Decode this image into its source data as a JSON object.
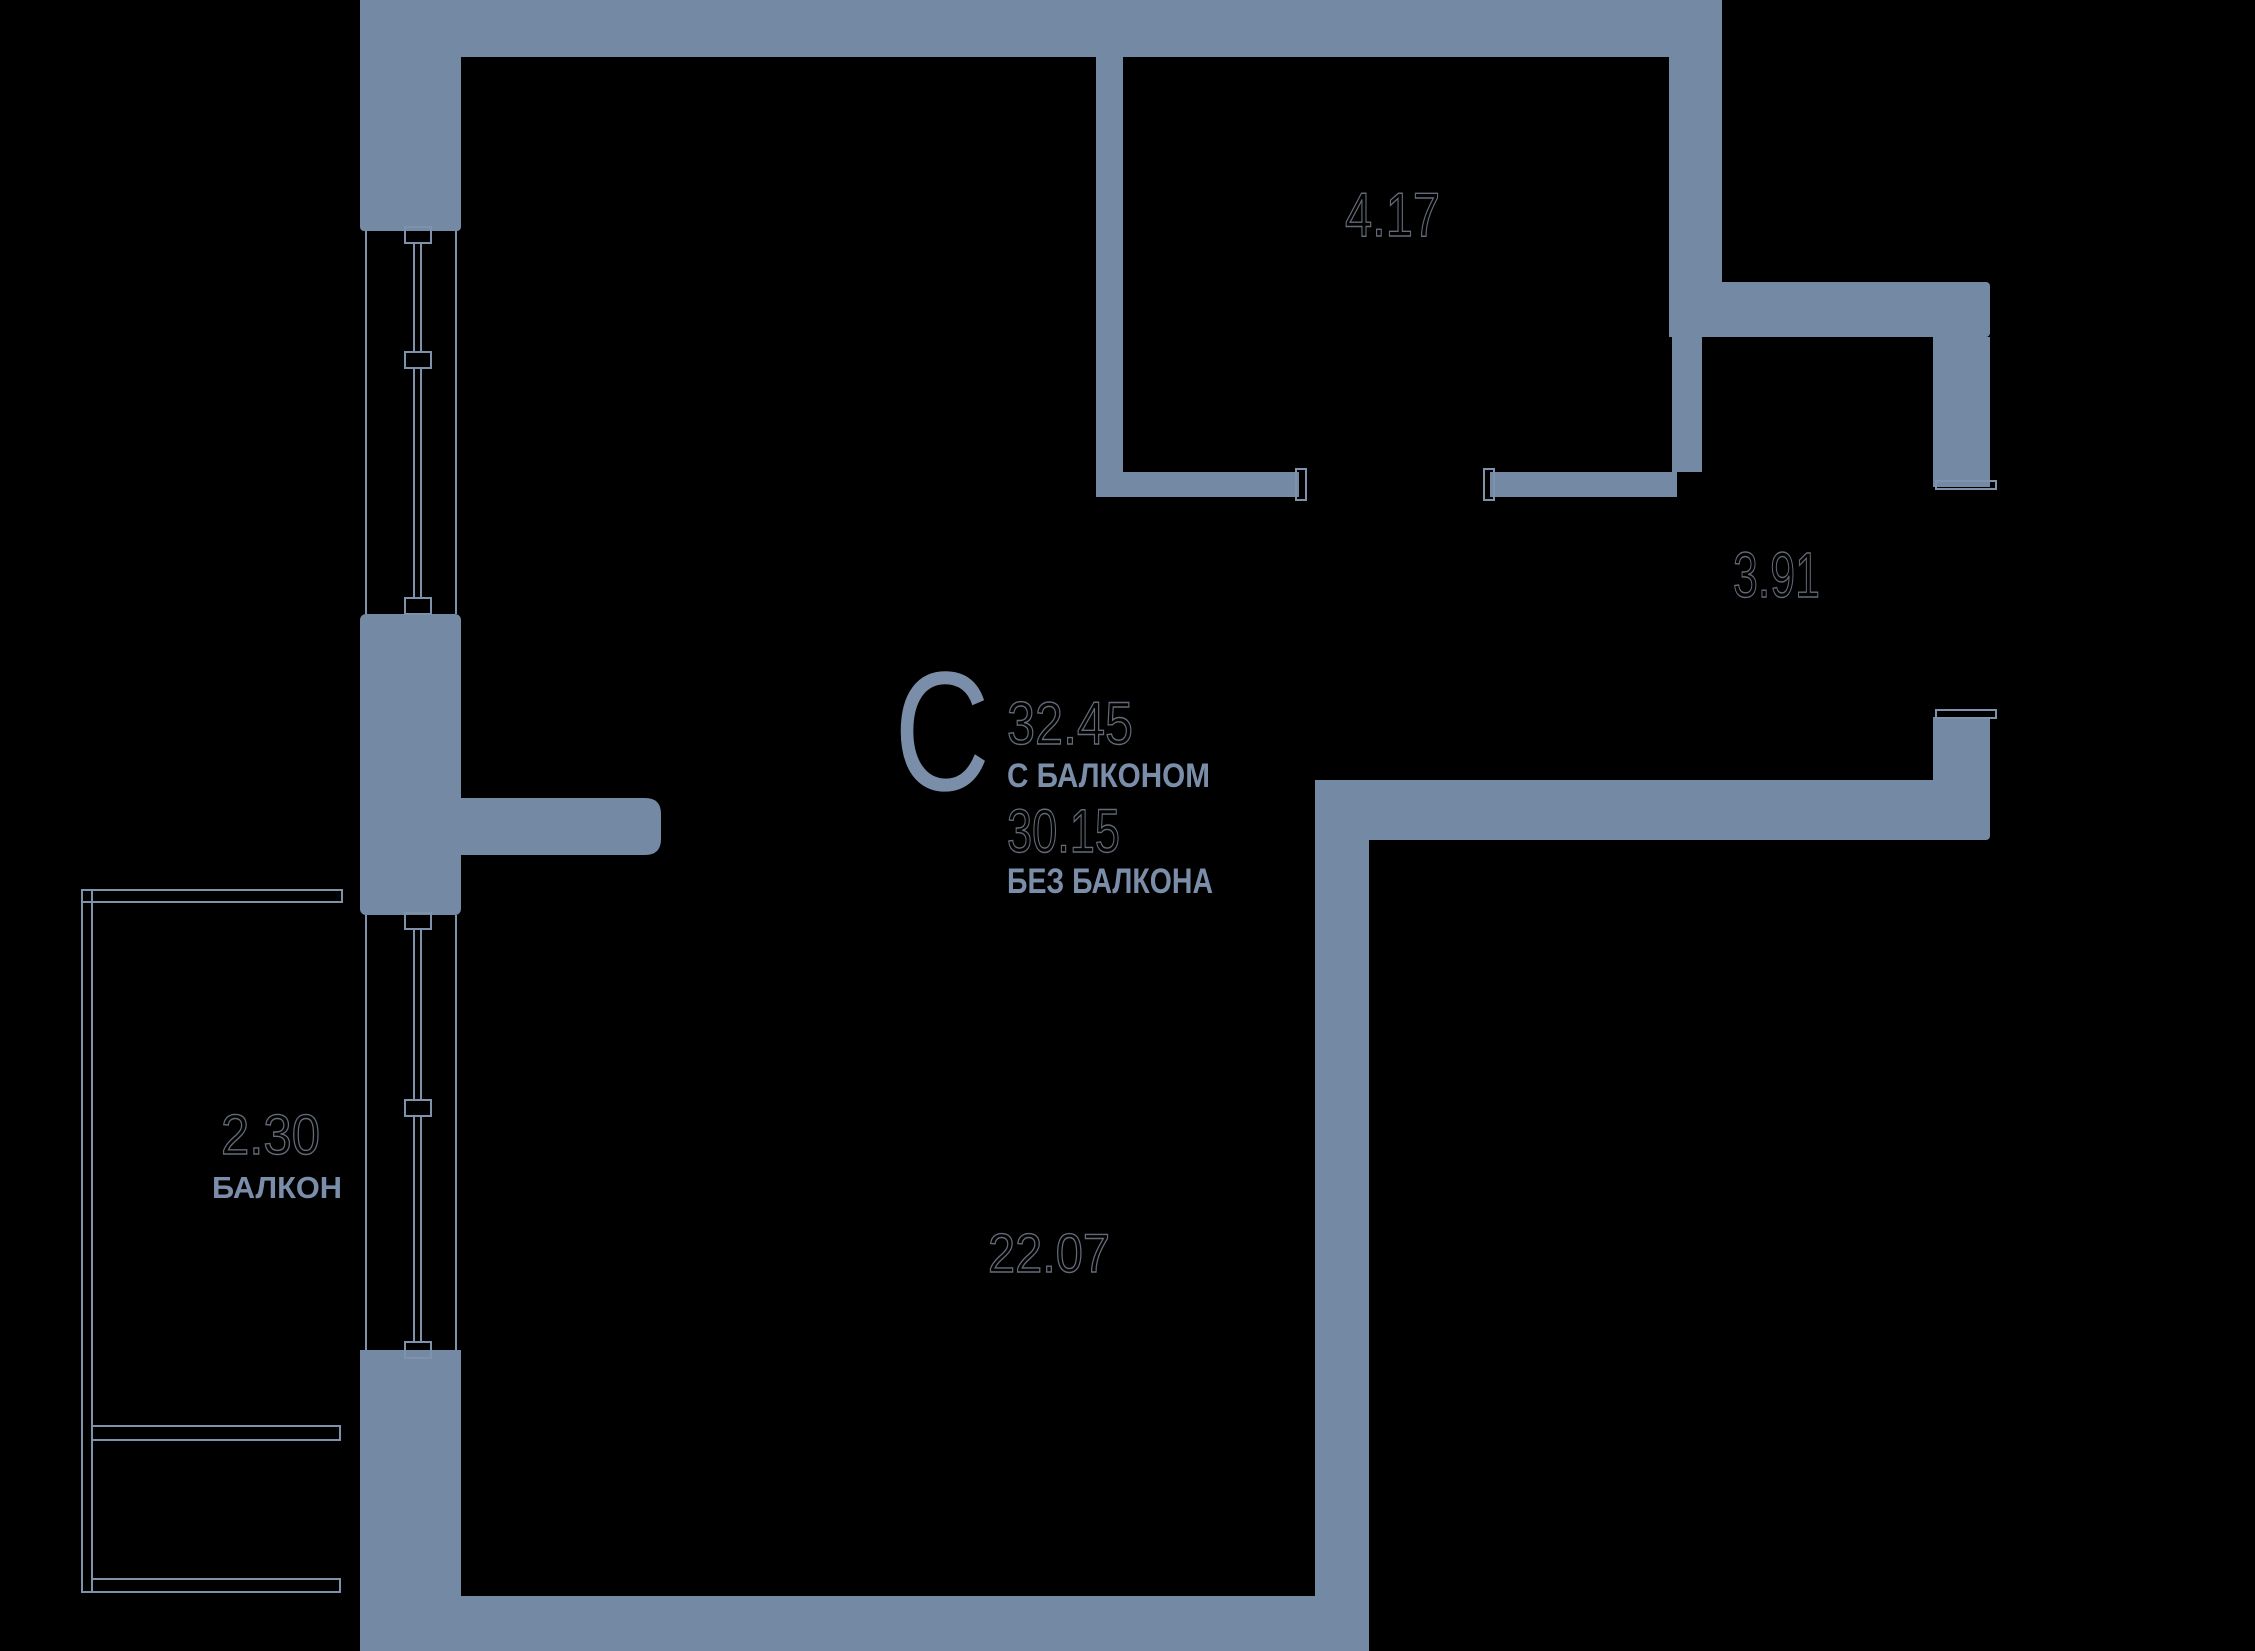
{
  "plan": {
    "type_letter": "С",
    "area_with_balcony": "32.45",
    "with_balcony_label": "С БАЛКОНОМ",
    "area_without_balcony": "30.15",
    "without_balcony_label": "БЕЗ БАЛКОНА",
    "rooms": [
      {
        "name": "bathroom",
        "area": "4.17"
      },
      {
        "name": "hallway",
        "area": "3.91"
      },
      {
        "name": "living-room",
        "area": "22.07"
      },
      {
        "name": "balcony",
        "area": "2.30",
        "label": "БАЛКОН"
      }
    ],
    "colors": {
      "background": "#000000",
      "wall": "#7489A4",
      "line": "#7E92AC",
      "label_text": "#7B8EA9",
      "number_outline": "#646B77"
    }
  }
}
